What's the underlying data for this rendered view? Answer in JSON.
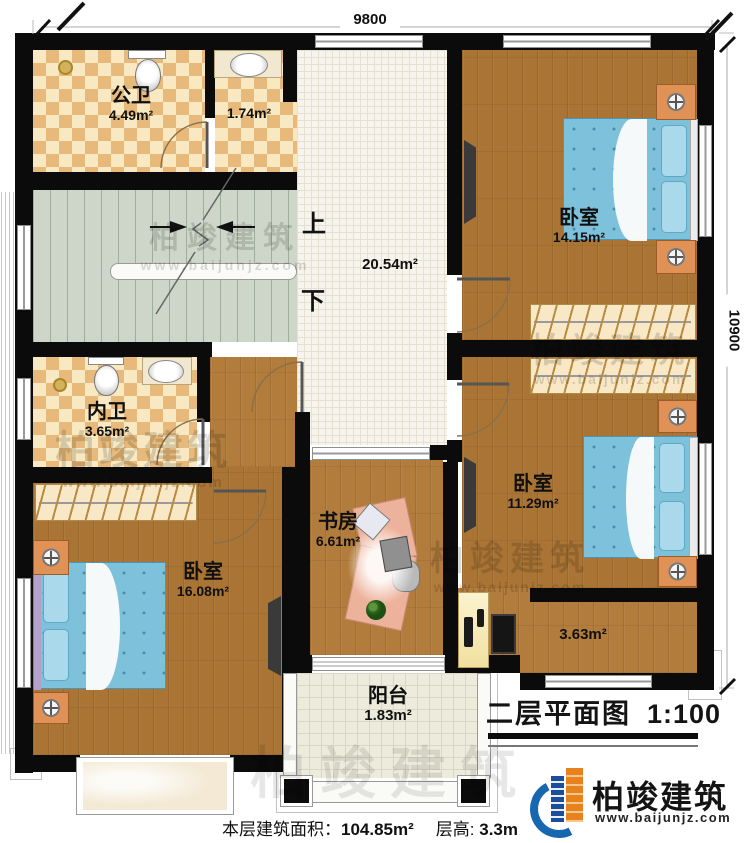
{
  "dimensions": {
    "width_top": "9800",
    "height_right": "10900"
  },
  "stair_labels": {
    "up": "上",
    "down": "下"
  },
  "rooms": {
    "public_bath": {
      "name": "公卫",
      "area": "4.49m²"
    },
    "wash": {
      "area": "1.74m²"
    },
    "hall": {
      "area": "20.54m²"
    },
    "bedroom_top_right": {
      "name": "卧室",
      "area": "14.15m²"
    },
    "private_bath": {
      "name": "内卫",
      "area": "3.65m²"
    },
    "bedroom_mid_right": {
      "name": "卧室",
      "area": "11.29m²"
    },
    "study": {
      "name": "书房",
      "area": "6.61m²"
    },
    "bedroom_left": {
      "name": "卧室",
      "area": "16.08m²"
    },
    "corridor": {
      "area": "3.63m²"
    },
    "balcony": {
      "name": "阳台",
      "area": "1.83m²"
    }
  },
  "title": {
    "name": "二层平面图",
    "scale": "1:100"
  },
  "logo": {
    "company": "柏竣建筑",
    "website": "www.baijunjz.com"
  },
  "footer": {
    "floor_area_label": "本层建筑面积：",
    "floor_area": "104.85m²",
    "floor_height_label": "层高:",
    "floor_height": "3.3m"
  },
  "watermark": {
    "company": "柏竣建筑",
    "website": "www.baijunjz.com"
  },
  "colors": {
    "wall": "#0b0b0b",
    "logo_blue": "#1766b0",
    "logo_orange": "#e8821e",
    "bed_blue": "#7ec1da",
    "wood": "#b27c3c"
  }
}
